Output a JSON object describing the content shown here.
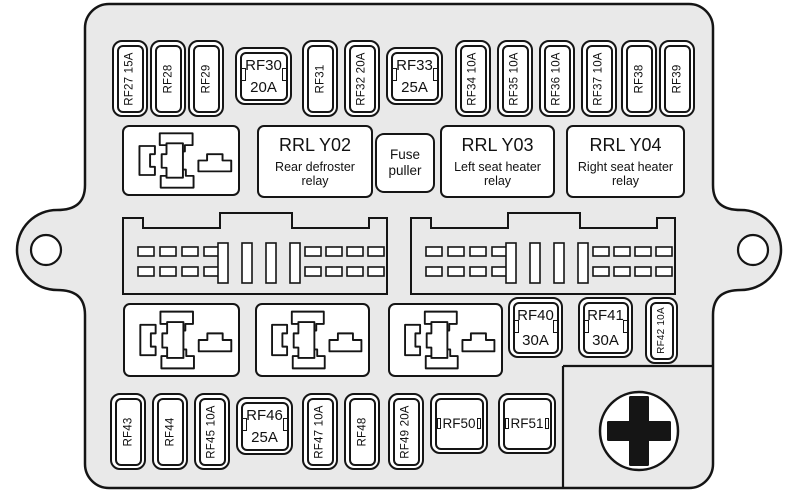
{
  "colors": {
    "body_fill": "#e9e9e9",
    "outline": "#151515",
    "fuse_fill": "#ffffff"
  },
  "top_row": [
    {
      "label": "RF27 15A",
      "style": "mini"
    },
    {
      "label": "RF28",
      "style": "mini"
    },
    {
      "label": "RF29",
      "style": "mini"
    },
    {
      "label": "RF30",
      "amp": "20A",
      "style": "square"
    },
    {
      "label": "RF31",
      "style": "mini"
    },
    {
      "label": "RF32 20A",
      "style": "mini"
    },
    {
      "label": "RF33",
      "amp": "25A",
      "style": "square"
    },
    {
      "label": "RF34 10A",
      "style": "mini"
    },
    {
      "label": "RF35 10A",
      "style": "mini"
    },
    {
      "label": "RF36 10A",
      "style": "mini"
    },
    {
      "label": "RF37 10A",
      "style": "mini"
    },
    {
      "label": "RF38",
      "style": "mini"
    },
    {
      "label": "RF39",
      "style": "mini"
    }
  ],
  "relay_row": {
    "boxes": [
      {
        "title": "RRL Y02",
        "desc": "Rear defroster relay"
      },
      {
        "title": "RRL Y03",
        "desc": "Left seat heater relay"
      },
      {
        "title": "RRL Y04",
        "desc": "Right seat heater relay"
      }
    ],
    "fuse_puller_label": "Fuse puller"
  },
  "third_row": [
    {
      "label": "RF40",
      "amp": "30A",
      "style": "square"
    },
    {
      "label": "RF41",
      "amp": "30A",
      "style": "square"
    },
    {
      "label": "RF42 10A",
      "style": "mini"
    }
  ],
  "bottom_row": [
    {
      "label": "RF43",
      "style": "mini"
    },
    {
      "label": "RF44",
      "style": "mini"
    },
    {
      "label": "RF45 10A",
      "style": "mini"
    },
    {
      "label": "RF46",
      "amp": "25A",
      "style": "square"
    },
    {
      "label": "RF47 10A",
      "style": "mini"
    },
    {
      "label": "RF48",
      "style": "mini"
    },
    {
      "label": "RF49 20A",
      "style": "mini"
    },
    {
      "label": "RF50",
      "style": "clip"
    },
    {
      "label": "RF51",
      "style": "clip"
    }
  ],
  "icons": {
    "relay_socket": "relay-socket-icon",
    "connector": "harness-connector-icon",
    "battery_positive": "battery-positive-icon",
    "mounting_hole": "mounting-hole"
  }
}
